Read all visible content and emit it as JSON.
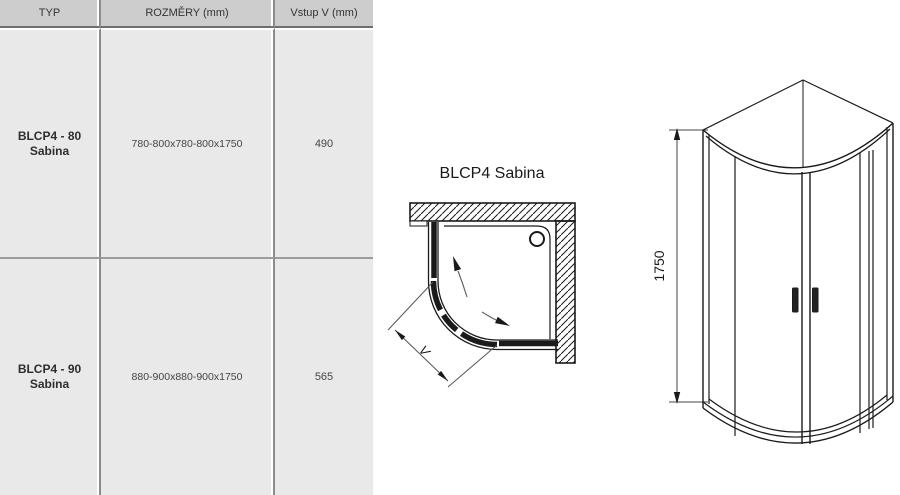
{
  "colors": {
    "header_bg": "#cdcdcd",
    "cell_bg": "#e9e9e9",
    "grid_line": "#8c8c8c",
    "drawing_ink": "#1a1a1a"
  },
  "table": {
    "columns": [
      {
        "label": "TYP"
      },
      {
        "label": "ROZMĚRY (mm)"
      },
      {
        "label": "Vstup V (mm)"
      }
    ],
    "rows": [
      {
        "type_line1": "BLCP4 - 80",
        "type_line2": "Sabina",
        "dimensions": "780-800x780-800x1750",
        "entry": "490"
      },
      {
        "type_line1": "BLCP4 - 90",
        "type_line2": "Sabina",
        "dimensions": "880-900x880-900x1750",
        "entry": "565"
      }
    ]
  },
  "top_view": {
    "title": "BLCP4 Sabina",
    "entry_dimension_label": "V"
  },
  "front_view": {
    "height_dimension_label": "1750"
  }
}
